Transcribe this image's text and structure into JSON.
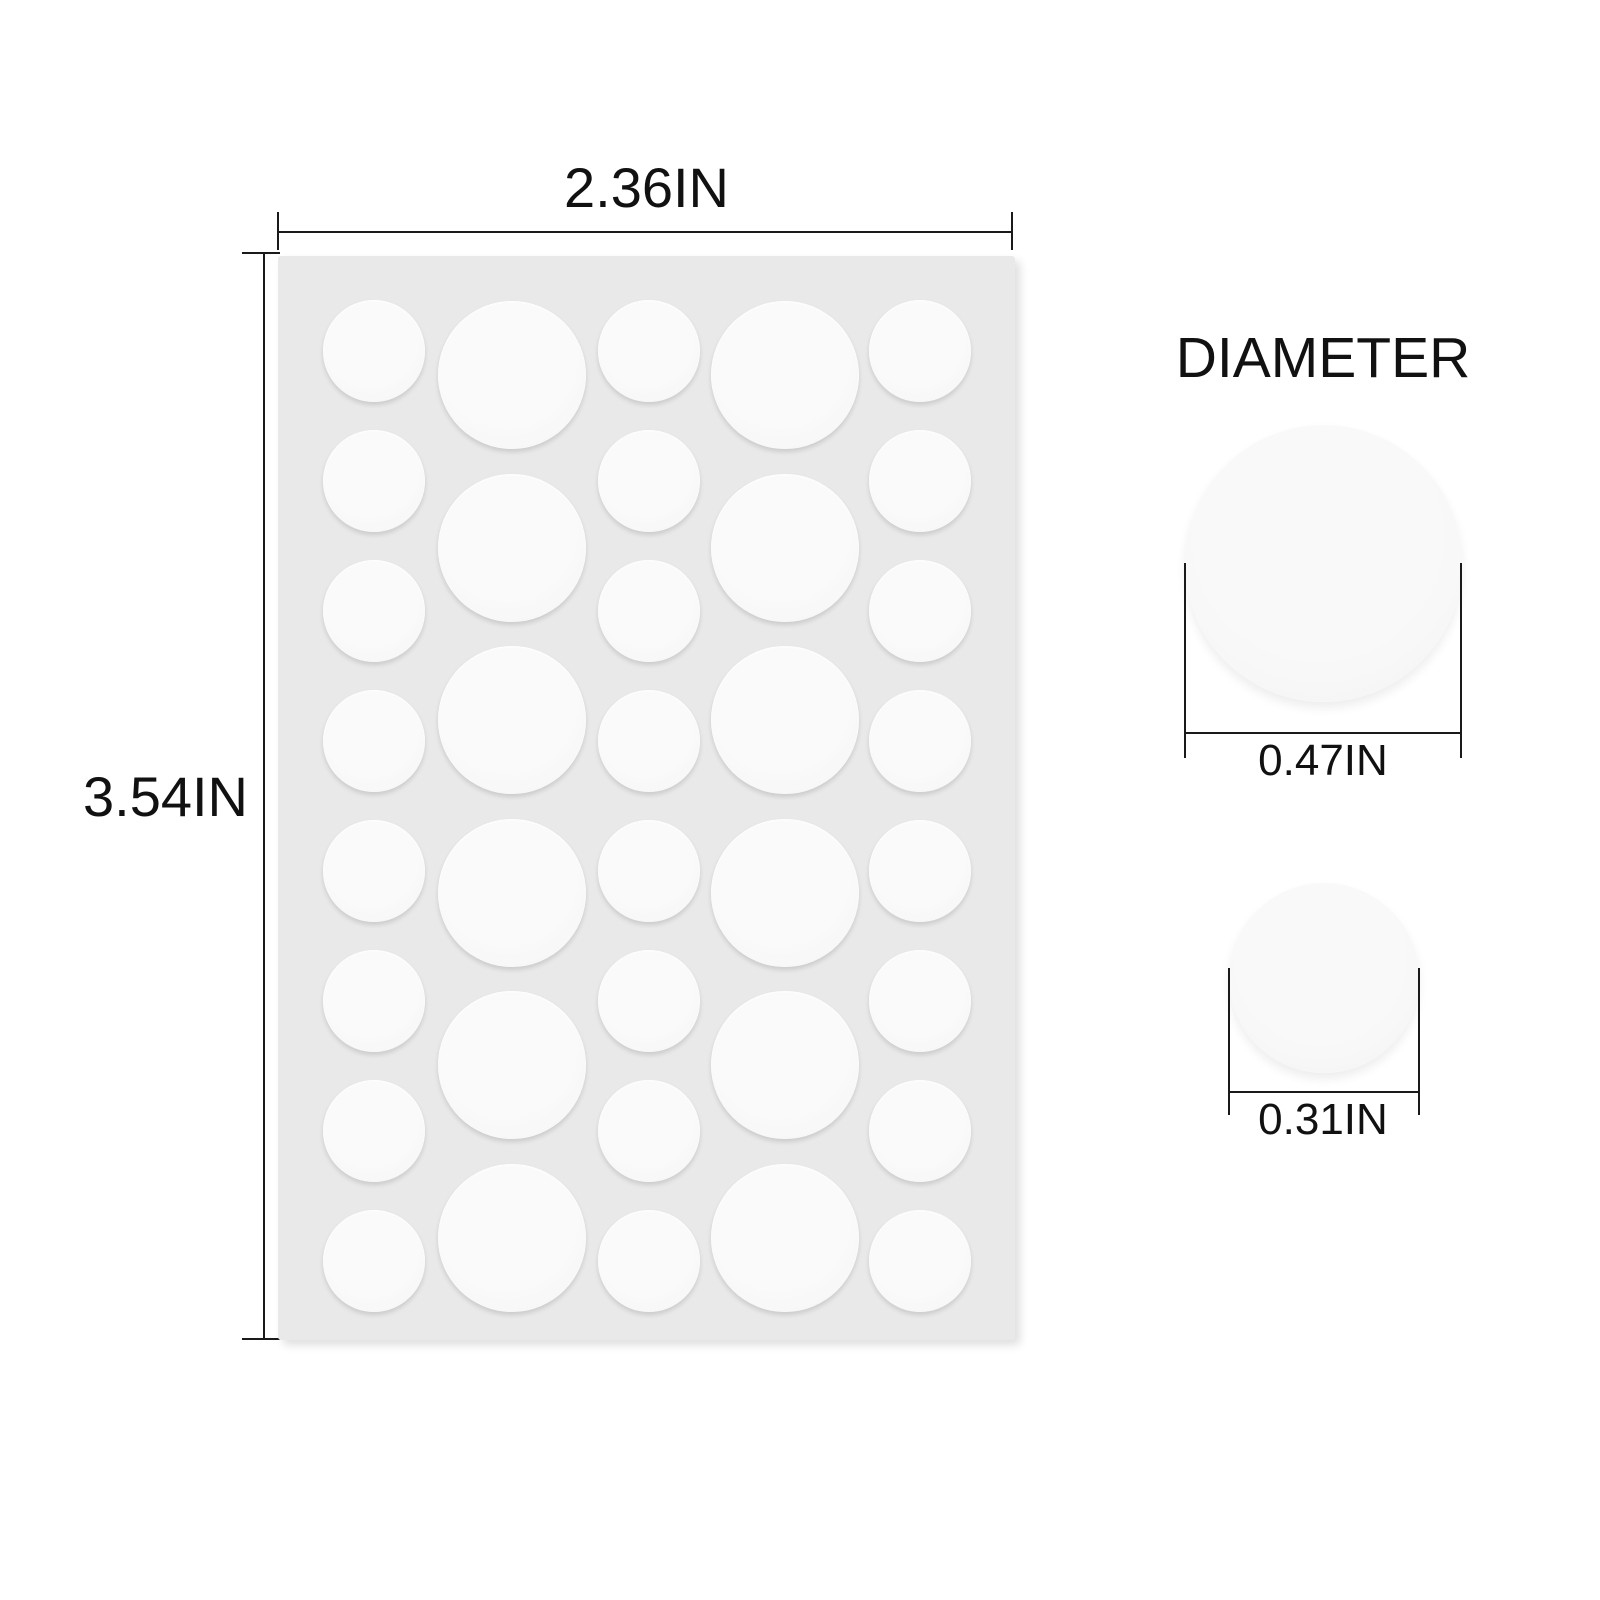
{
  "background": "#ffffff",
  "sheet": {
    "color": "#e9e9e9",
    "dot_color": "#f7f7f7",
    "dimensions": {
      "width_label": "2.36IN",
      "height_label": "3.54IN"
    },
    "dots": {
      "small": {
        "radius": 51,
        "cx": [
          374,
          649,
          920
        ],
        "cy": [
          351,
          481,
          611,
          741,
          871,
          1001,
          1131,
          1261
        ]
      },
      "large": {
        "radius": 74,
        "cx": [
          512,
          785
        ],
        "cy": [
          375,
          548,
          720,
          893,
          1065,
          1238
        ]
      }
    }
  },
  "diameter_panel": {
    "title": "DIAMETER",
    "examples": [
      {
        "name": "large",
        "label": "0.47IN"
      },
      {
        "name": "small",
        "label": "0.31IN"
      }
    ]
  },
  "colors": {
    "line": "#1a1a1a",
    "text": "#111111"
  }
}
